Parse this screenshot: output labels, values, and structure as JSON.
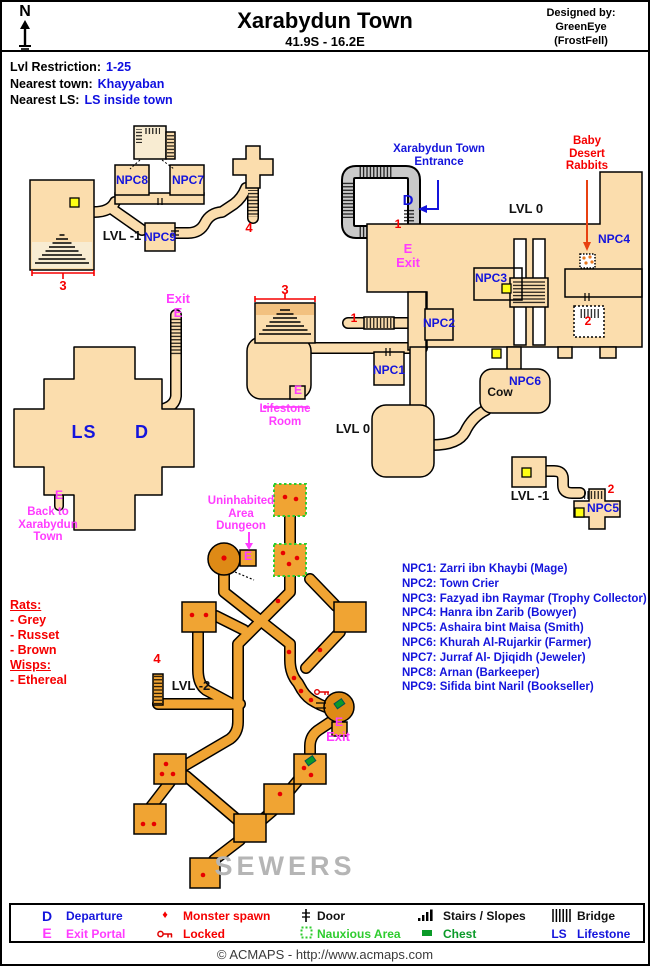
{
  "header": {
    "north": "N",
    "title": "Xarabydun Town",
    "coordinates": "41.9S - 16.2E",
    "designed_by": "Designed by:",
    "designer": "GreenEye",
    "designer_note": "(FrostFell)"
  },
  "info": {
    "rows": [
      {
        "label": "Lvl Restriction:",
        "value": "1-25"
      },
      {
        "label": "Nearest town:",
        "value": "Khayyaban"
      },
      {
        "label": "Nearest LS:",
        "value": "LS inside town"
      }
    ]
  },
  "map": {
    "labels": {
      "exit_topleft": "Exit",
      "e_topleft": "E",
      "npc8": "NPC8",
      "npc7": "NPC7",
      "npc9": "NPC9",
      "lvl_m1_left": "LVL -1",
      "n4_top": "4",
      "n3_left": "3",
      "entrance": "Xarabydun Town Entrance",
      "d_entrance": "D",
      "n1_entrance": "1",
      "e_entrance": "E",
      "exit_entrance": "Exit",
      "rabbits": "Baby Desert Rabbits",
      "lvl0_right": "LVL 0",
      "npc4": "NPC4",
      "npc3": "NPC3",
      "npc2": "NPC2",
      "n1_mid": "1",
      "n2_right": "2",
      "npc6": "NPC6",
      "cow": "Cow",
      "npc1": "NPC1",
      "lvl0_mid": "LVL 0",
      "n3_mid": "3",
      "e_lifestone": "E",
      "lifestone": "Lifestone Room",
      "ls": "LS",
      "d_main": "D",
      "e_back": "E",
      "back": "Back to Xarabydun Town",
      "lvl_m1_right": "LVL -1",
      "n2_npc5": "2",
      "npc5": "NPC5",
      "uninhabited": "Uninhabited Area Dungeon",
      "e_dungeon": "E",
      "n4_sewer": "4",
      "lvl_m2": "LVL -2",
      "e_sewer": "E",
      "exit_sewer": "Exit",
      "sewers": "SEWERS"
    }
  },
  "npc_list": {
    "items": [
      "NPC1: Zarri ibn Khaybi (Mage)",
      "NPC2: Town Crier",
      "NPC3: Fazyad ibn Raymar (Trophy Collector)",
      "NPC4: Hanra ibn Zarib (Bowyer)",
      "NPC5: Ashaira bint Maisa (Smith)",
      "NPC6: Khurah Al-Rujarkir (Farmer)",
      "NPC7: Jurraf Al- Djiqidh (Jeweler)",
      "NPC8: Arnan (Barkeeper)",
      "NPC9: Sifida bint Naril (Bookseller)"
    ]
  },
  "spawn_key": {
    "lines": [
      "Rats:",
      "- Grey",
      "- Russet",
      "- Brown",
      "Wisps:",
      "- Ethereal"
    ]
  },
  "legend": {
    "departure": {
      "symbol": "D",
      "label": "Departure"
    },
    "monster": {
      "symbol": "♦",
      "label": "Monster spawn"
    },
    "door": {
      "label": "Door"
    },
    "stairs": {
      "label": "Stairs / Slopes"
    },
    "bridge": {
      "label": "Bridge"
    },
    "exit_portal": {
      "symbol": "E",
      "label": "Exit Portal"
    },
    "locked": {
      "label": "Locked"
    },
    "nauxious": {
      "label": "Nauxious Area"
    },
    "chest": {
      "label": "Chest"
    },
    "lifestone": {
      "symbol": "LS",
      "label": "Lifestone"
    }
  },
  "footer": {
    "text": "© ACMAPS - http://www.acmaps.com"
  },
  "colors": {
    "town_floor": "#fbddad",
    "sewer_floor": "#f0a433",
    "round_room": "#de8a16",
    "entrance_grey": "#c9c9c9",
    "accent_blue": "#1414dc",
    "accent_red": "#f50000",
    "accent_magenta": "#ff3cff",
    "nauxious_green": "#2ecc2e",
    "chest_green": "#0a9a28",
    "marker_yellow": "#ffff14"
  }
}
